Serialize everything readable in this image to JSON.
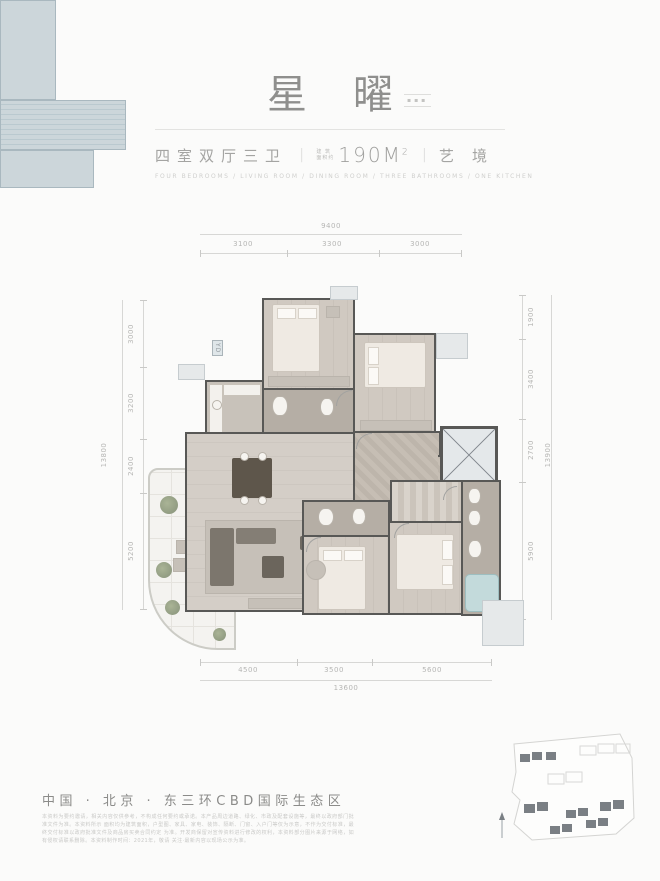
{
  "header": {
    "title": "星曜",
    "edition_label": "▪▪▪",
    "subtitle": {
      "rooms": "四室双厅三卫",
      "divider": "|",
      "area_prefix_top": "建 筑",
      "area_prefix_bottom": "面积约",
      "area_value": "190M",
      "area_sup": "2",
      "suffix": "艺境"
    },
    "english_caption": "FOUR BEDROOMS / LIVING ROOM / DINING ROOM / THREE BATHROOMS / ONE KITCHEN"
  },
  "plan": {
    "dims": {
      "top": {
        "overall": "9400",
        "segments": [
          "3100",
          "3300",
          "3000"
        ]
      },
      "bottom": {
        "overall": "13600",
        "segments": [
          "4500",
          "3500",
          "5600"
        ]
      },
      "left": {
        "overall": "13800",
        "segments": [
          "3000",
          "3200",
          "2400",
          "5200"
        ]
      },
      "right": {
        "overall": "13900",
        "segments": [
          "1900",
          "3400",
          "2700",
          "5900"
        ]
      }
    },
    "labels": {
      "duct": "YD"
    }
  },
  "footer": {
    "location": "中国 · 北京 · 东三环CBD国际生态区",
    "disclaimer_lines": [
      "本资料为要约邀请，相关内容仅供参考，不构成任何要约或承诺。本产品周边道路、绿化、市政及配套设施等，最终以政府部门批准文件为准。本资料所示",
      "面积均为建筑面积，户型图、家具、家电、装饰、隔断、门窗、入户门等仅为示意，不作为交付标准，最终交付标准以政府批准文件及商品房买卖合同约定",
      "为准。开发商保留对宣传资料进行修改的权利，本资料部分图片来源于网络，如有侵权请联系删除。本资料制作时间：2021年，敬请",
      "关注·最新内容以现场公示为准。"
    ]
  },
  "colors": {
    "wall": "#585856",
    "balcony": "#ccd6da",
    "floor_wood": "#cfc8c0",
    "floor_stone": "#b5aea5",
    "dimension_text": "#b6b6b4",
    "title_gray": "#8f8f8d",
    "tub_teal": "#c3dadb",
    "site_building": "#7a7f84"
  }
}
